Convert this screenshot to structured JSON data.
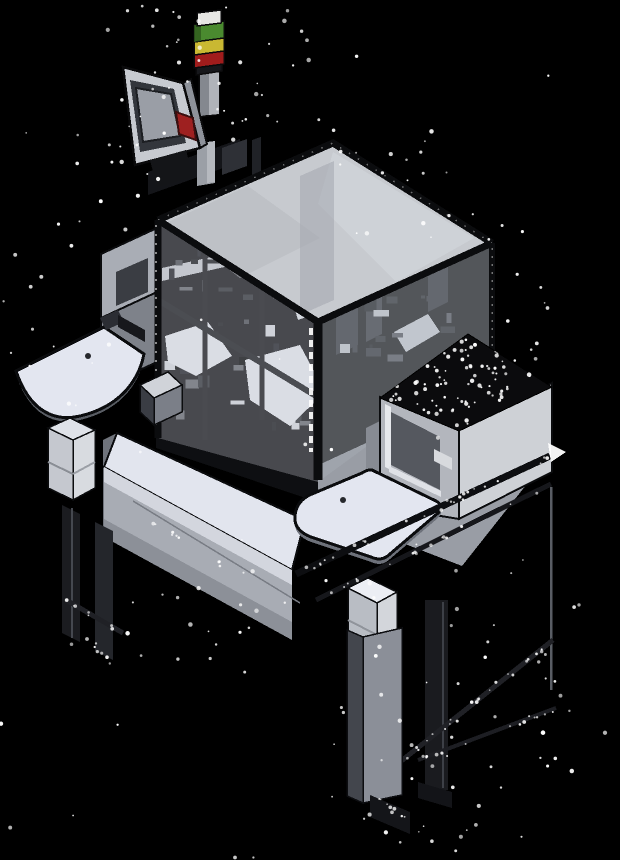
{
  "scene": {
    "kind": "isometric-cad-render",
    "subject": "automated-assembly-machine"
  },
  "colors": {
    "background": "#000000",
    "stack_cap": "#e7e7e4",
    "stack_green": "#4a8a2f",
    "stack_yellow": "#c9b832",
    "stack_red": "#a01c1c",
    "button_red": "#9e2020",
    "screen": "#9a9ea6",
    "enclosure_glass": "#b9bdc5",
    "enclosure_glass_right": "#a6abb4",
    "table_top": "#e2e5ee",
    "tray": "#e3e6f0",
    "noise": "#ffffff"
  },
  "stack_light": {
    "segments": [
      "green",
      "yellow",
      "red"
    ]
  }
}
